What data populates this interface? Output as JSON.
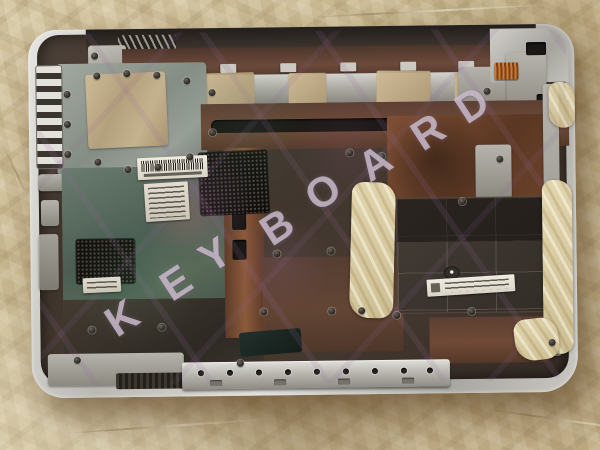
{
  "watermark": {
    "text": "KEYBOARD",
    "letters": [
      "K",
      "E",
      "Y",
      "B",
      "O",
      "A",
      "R",
      "D"
    ]
  },
  "palette": {
    "paper": "#ccbc96",
    "rim_silver": "#d2d1cb",
    "interior_dark": "#41372e",
    "copper": "#7a4b33",
    "teal_plate": "#5c6e63",
    "foil_tan": "#c3ae8d",
    "label_white": "#e9e5da",
    "mesh_black": "#141210",
    "watermark_white": "rgba(244,238,246,0.60)"
  }
}
